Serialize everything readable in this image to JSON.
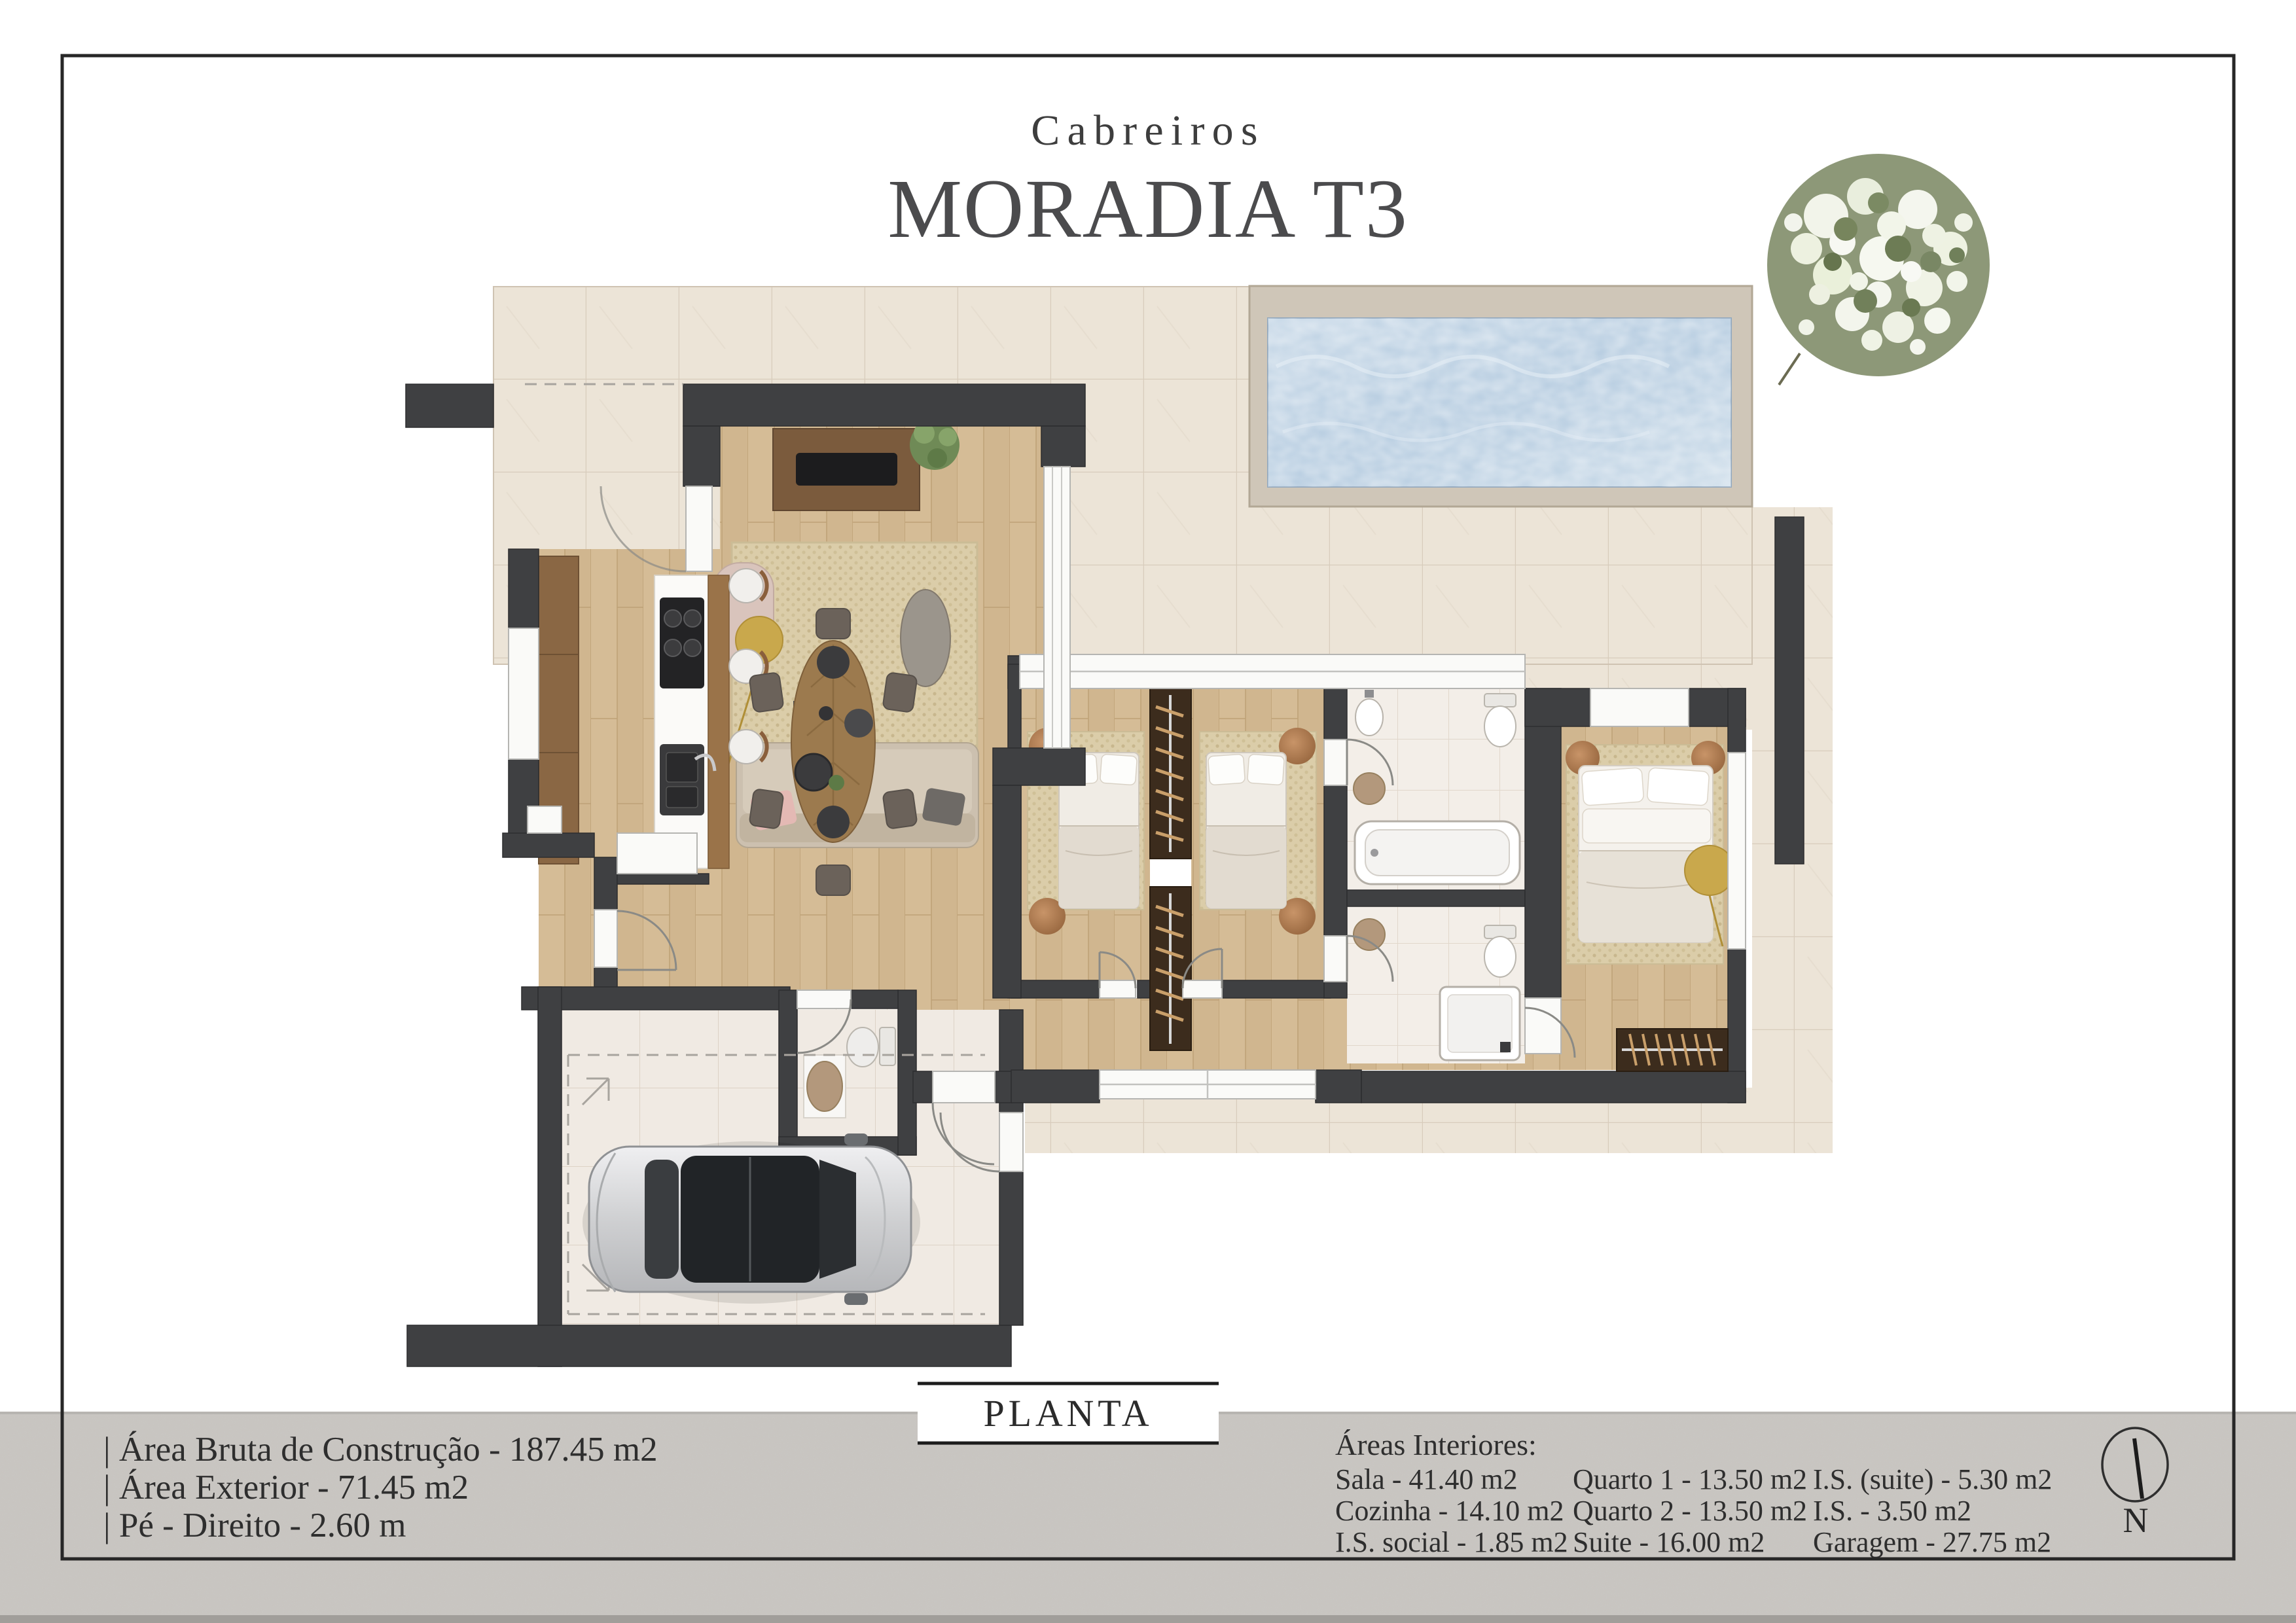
{
  "page": {
    "brand": "Cabreiros",
    "title": "MORADIA T3",
    "plan_label": "PLANTA",
    "compass_label": "N"
  },
  "specs": [
    "| Área Bruta de Construção - 187.45 m2",
    "| Área Exterior - 71.45 m2",
    "| Pé - Direito - 2.60 m"
  ],
  "areas": {
    "heading": "Áreas Interiores:",
    "columns": [
      [
        "Sala - 41.40 m2",
        "Cozinha - 14.10 m2",
        "I.S. social - 1.85 m2"
      ],
      [
        "Quarto 1 - 13.50 m2",
        "Quarto 2 - 13.50 m2",
        "Suite - 16.00 m2"
      ],
      [
        "I.S. (suite) - 5.30 m2",
        "I.S. - 3.50 m2",
        "Garagem - 27.75 m2"
      ]
    ]
  },
  "colors": {
    "wall": "#3f4042",
    "wood": "#d5bc96",
    "terrace": "#ece4d7",
    "bath_tile": "#f3eee8",
    "garage_tile": "#f0eae3",
    "pool_water": "#b9cfe2",
    "pool_deck": "#cfc6b8",
    "tree": "#8d9878",
    "rug": "#dbcda9",
    "strip": "#c9c6c2",
    "frame": "#272727"
  }
}
